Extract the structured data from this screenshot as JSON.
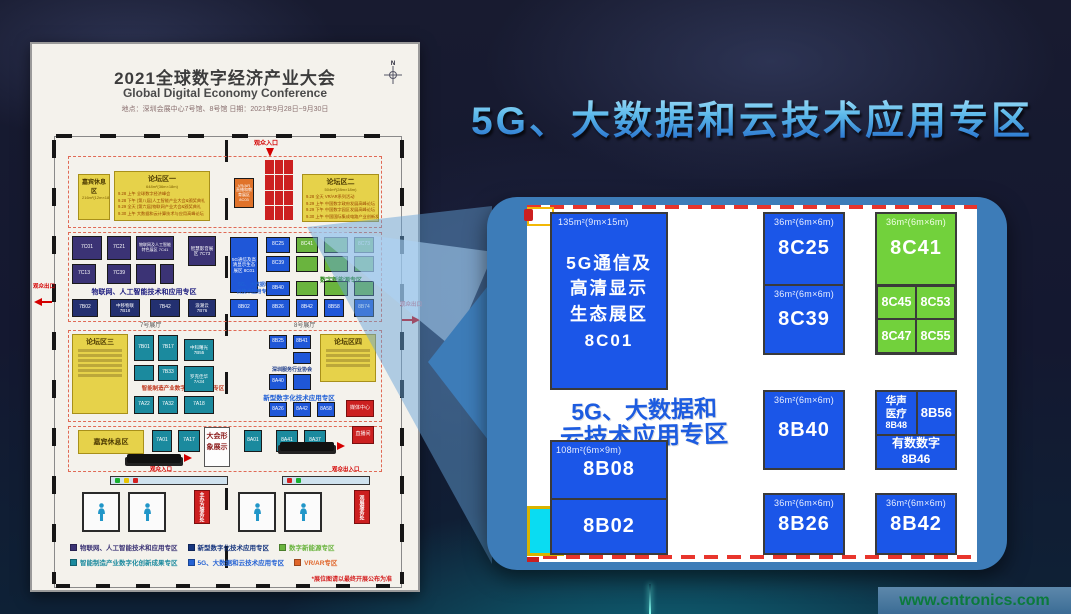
{
  "page": {
    "watermark": "www.cntronics.com"
  },
  "headline": {
    "text": "5G、大数据和云技术应用专区"
  },
  "floorplan": {
    "header": {
      "title": "2021全球数字经济产业大会",
      "subtitle": "Global Digital Economy Conference",
      "meta": "地点：深圳会展中心7号馆、8号馆      日期：2021年9月28日~9月30日",
      "compass_n": "N"
    },
    "entrances": {
      "top": "观众入口",
      "left": "观众出口",
      "right": "观众出口",
      "bottom_in": "观众入口",
      "bottom_inout": "观众出入口"
    },
    "halls": {
      "h7": "7号展厅",
      "h8": "8号展厅"
    },
    "areas": {
      "guest_rest": {
        "name": "嘉宾休息区",
        "size": "216m²(12m×18m)"
      },
      "forum1": {
        "name": "论坛区一",
        "size": "648m²(36m×18m)",
        "schedule": [
          "9.28 上午  全球数字经济峰会",
          "9.28 下午  (第八届)人工智能产业大会&颁奖典礼",
          "9.29 全天  (第六届)物联网产业大会&颁奖典礼",
          "9.30 上午  大数据和云计算技术与应用高峰论坛"
        ]
      },
      "forum2": {
        "name": "论坛区二",
        "size": "504m²(28m×18m)",
        "schedule": [
          "9.28 全天  VR/AR系列活动",
          "9.29 上午  中国数字政府发展高峰论坛",
          "9.29 下午  中国数字园区发展高峰论坛",
          "9.30 上午  中国国际集成电路产业创新发展高峰论坛"
        ]
      },
      "forum3": {
        "name": "论坛区三"
      },
      "forum4": {
        "name": "论坛区四"
      },
      "vrar": {
        "l1": "VR/AR",
        "l2": "直播和教育展区",
        "code": "8C03"
      },
      "rest2": "嘉宾休息区",
      "display": "大会形象展示",
      "media": "媒体中心",
      "live": "直播间",
      "service_host": "主办方服务处",
      "service_visitor": "观展服务处"
    },
    "zones": {
      "iot": "物联网、人工智能技术和应用专区",
      "energy": "数字新能源专区",
      "g5_l1": "5G、大数据和",
      "g5_l2": "云技术应用专区",
      "digital": "新型数字化技术应用专区",
      "smart": "智能制造产业数字化创新成果专区"
    },
    "booths": {
      "c7c01": "7C01",
      "c7c21": "7C21",
      "c7c41": "物联网及人工智能特色展区 7C41",
      "c7c73": "智慧影音展区 7C73",
      "c7c13": "7C13",
      "c7c39": "7C39",
      "b7b02": "7B02",
      "b7b18": "中移物联 7B18",
      "b7b42": "7B42",
      "b7b76": "浪潮云 7B76",
      "c8c01": "5G通信及高清显示生态展区 8C01",
      "c8c25": "8C25",
      "c8c39": "8C39",
      "c8c41": "8C41",
      "c8c73": "8C73",
      "b8b40": "8B40",
      "b8b02": "8B02",
      "b8b26": "8B26",
      "b8b42": "8B42",
      "b8b58": "8B58",
      "b8b74": "8B74",
      "b7b01": "7B01",
      "b7b17": "7B17",
      "b7b55": "中科曙光 7B55",
      "b7b33": "7B33",
      "b7a34": "罗克佳华 7A34",
      "b7a32": "7A32",
      "b7a22": "7A22",
      "b7a18": "7A18",
      "b7a01": "7A01",
      "b7a17": "7A17",
      "b8b25": "8B25",
      "b8b41": "8B41",
      "assoc": "深圳服务行业协会",
      "b8a40": "8A40",
      "b8a26": "8A26",
      "b8a42": "8A42",
      "b8a58": "8A58",
      "b8a01": "8A01",
      "b8a41": "8A41",
      "b8a37": "8A37"
    },
    "legend": [
      {
        "color": "#3b3375",
        "label": "物联网、人工智能技术和应用专区"
      },
      {
        "color": "#16357e",
        "label": "新型数字化技术应用专区"
      },
      {
        "color": "#6ab43e",
        "label": "数字新能源专区"
      },
      {
        "color": "#1b8a9e",
        "label": "智能制造产业数字化创新成果专区"
      },
      {
        "color": "#2563d4",
        "label": "5G、大数据和云技术应用专区"
      },
      {
        "color": "#e0662a",
        "label": "VR/AR专区"
      }
    ],
    "footnote": "*展位图请以最终开展公布为准"
  },
  "panel": {
    "zone": {
      "line1": "5G、大数据和",
      "line2": "云技术应用专区"
    },
    "sizes": {
      "s135": "135m²(9m×15m)",
      "s108": "108m²(6m×9m)",
      "s36": "36m²(6m×6m)"
    },
    "b8c01": {
      "l1": "5G通信及",
      "l2": "高清显示",
      "l3": "生态展区",
      "code": "8C01"
    },
    "b8c25": "8C25",
    "b8c39": "8C39",
    "b8c41": {
      "code": "8C41",
      "tl": "8C45",
      "tr": "8C53",
      "bl": "8C47",
      "br": "8C55"
    },
    "b8b40": "8B40",
    "b8b48": {
      "n1": "华声",
      "n2": "医疗",
      "code": "8B48"
    },
    "b8b56": "8B56",
    "b8b46": {
      "name": "有数数字",
      "code": "8B46"
    },
    "b8b08": "8B08",
    "b8b02": "8B02",
    "b8b26": "8B26",
    "b8b42": "8B42"
  }
}
